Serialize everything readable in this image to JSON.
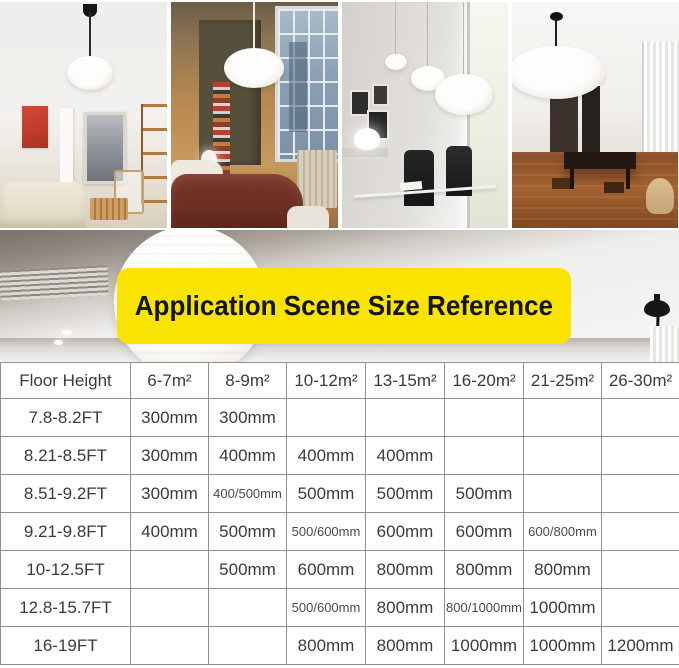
{
  "banner": {
    "label": "Application Scene Size Reference"
  },
  "colors": {
    "banner_bg": "#F8E400",
    "banner_text": "#141414",
    "table_border": "#8F8F8F",
    "table_text": "#3B3B3B",
    "lantern_white": "#FFFFFF"
  },
  "table": {
    "header": [
      "Floor Height",
      "6-7m²",
      "8-9m²",
      "10-12m²",
      "13-15m²",
      "16-20m²",
      "21-25m²",
      "26-30m²"
    ],
    "rows": [
      {
        "label": "7.8-8.2FT",
        "values": [
          "300mm",
          "300mm",
          "",
          "",
          "",
          "",
          ""
        ]
      },
      {
        "label": "8.21-8.5FT",
        "values": [
          "300mm",
          "400mm",
          "400mm",
          "400mm",
          "",
          "",
          ""
        ]
      },
      {
        "label": "8.51-9.2FT",
        "values": [
          "300mm",
          "400/500mm",
          "500mm",
          "500mm",
          "500mm",
          "",
          ""
        ]
      },
      {
        "label": "9.21-9.8FT",
        "values": [
          "400mm",
          "500mm",
          "500/600mm",
          "600mm",
          "600mm",
          "600/800mm",
          ""
        ]
      },
      {
        "label": "10-12.5FT",
        "values": [
          "",
          "500mm",
          "600mm",
          "800mm",
          "800mm",
          "800mm",
          ""
        ]
      },
      {
        "label": "12.8-15.7FT",
        "values": [
          "",
          "",
          "500/600mm",
          "800mm",
          "800/1000mm",
          "1000mm",
          ""
        ]
      },
      {
        "label": "16-19FT",
        "values": [
          "",
          "",
          "800mm",
          "800mm",
          "1000mm",
          "1000mm",
          "1200mm"
        ]
      }
    ]
  }
}
